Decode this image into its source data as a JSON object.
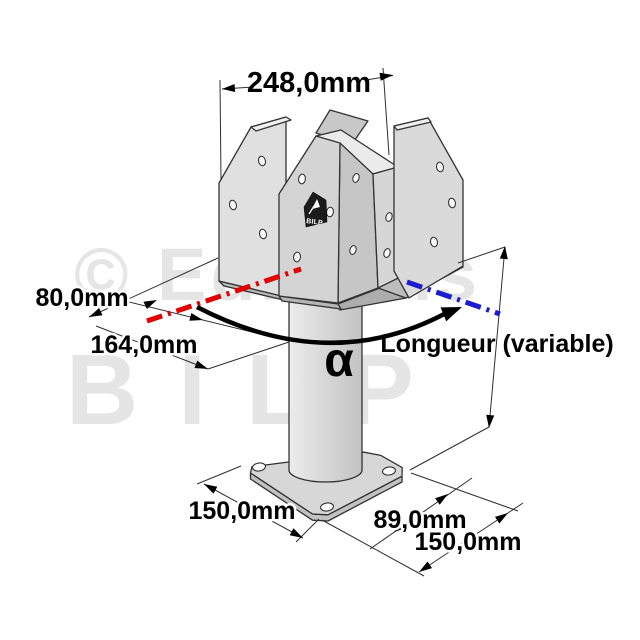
{
  "watermark": {
    "line1": "© Editions",
    "line2": "BILP"
  },
  "labels": {
    "top_width": "248,0mm",
    "seat_width": "80,0mm",
    "overall_width": "164,0mm",
    "angle": "α",
    "length": "Longueur (variable)",
    "base_left": "150,0mm",
    "base_offset": "89,0mm",
    "base_right": "150,0mm"
  },
  "logo": {
    "text": "BILP"
  },
  "colors": {
    "axis_left": "#e10000",
    "axis_right": "#1b1bd1",
    "metal": "#d9d9d9",
    "watermark_gray": "#e5e5e5",
    "dimension_line": "#2f2f2f"
  }
}
